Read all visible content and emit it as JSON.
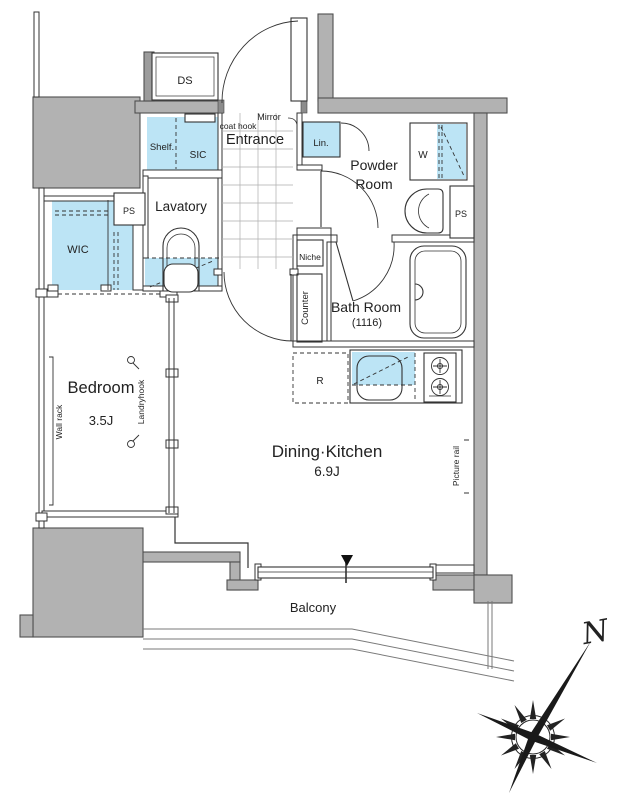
{
  "labels": {
    "ds": "DS",
    "shelf": "Shelf.",
    "sic": "SIC",
    "coat_hook": "coat hook",
    "entrance": "Entrance",
    "mirror": "Mirror",
    "lin": "Lin.",
    "powder_line1": "Powder",
    "powder_line2": "Room",
    "washer": "W",
    "ps_powder": "PS",
    "ps_lavatory": "PS",
    "lavatory": "Lavatory",
    "wic": "WIC",
    "niche": "Niche",
    "counter": "Counter",
    "bath": "Bath Room",
    "bath_size": "(1116)",
    "bedroom": "Bedroom",
    "bedroom_size": "3.5J",
    "wall_rack": "Wall rack",
    "laundry_hook": "Landryhook",
    "dining_kitchen": "Dining·Kitchen",
    "dining_kitchen_size": "6.9J",
    "picture_rail": "Picture rail",
    "refrigerator": "R",
    "balcony": "Balcony",
    "north": "N"
  },
  "colors": {
    "wall_fill": "#b2b2b2",
    "accent_blue": "#bce4f5",
    "line": "#333333"
  }
}
